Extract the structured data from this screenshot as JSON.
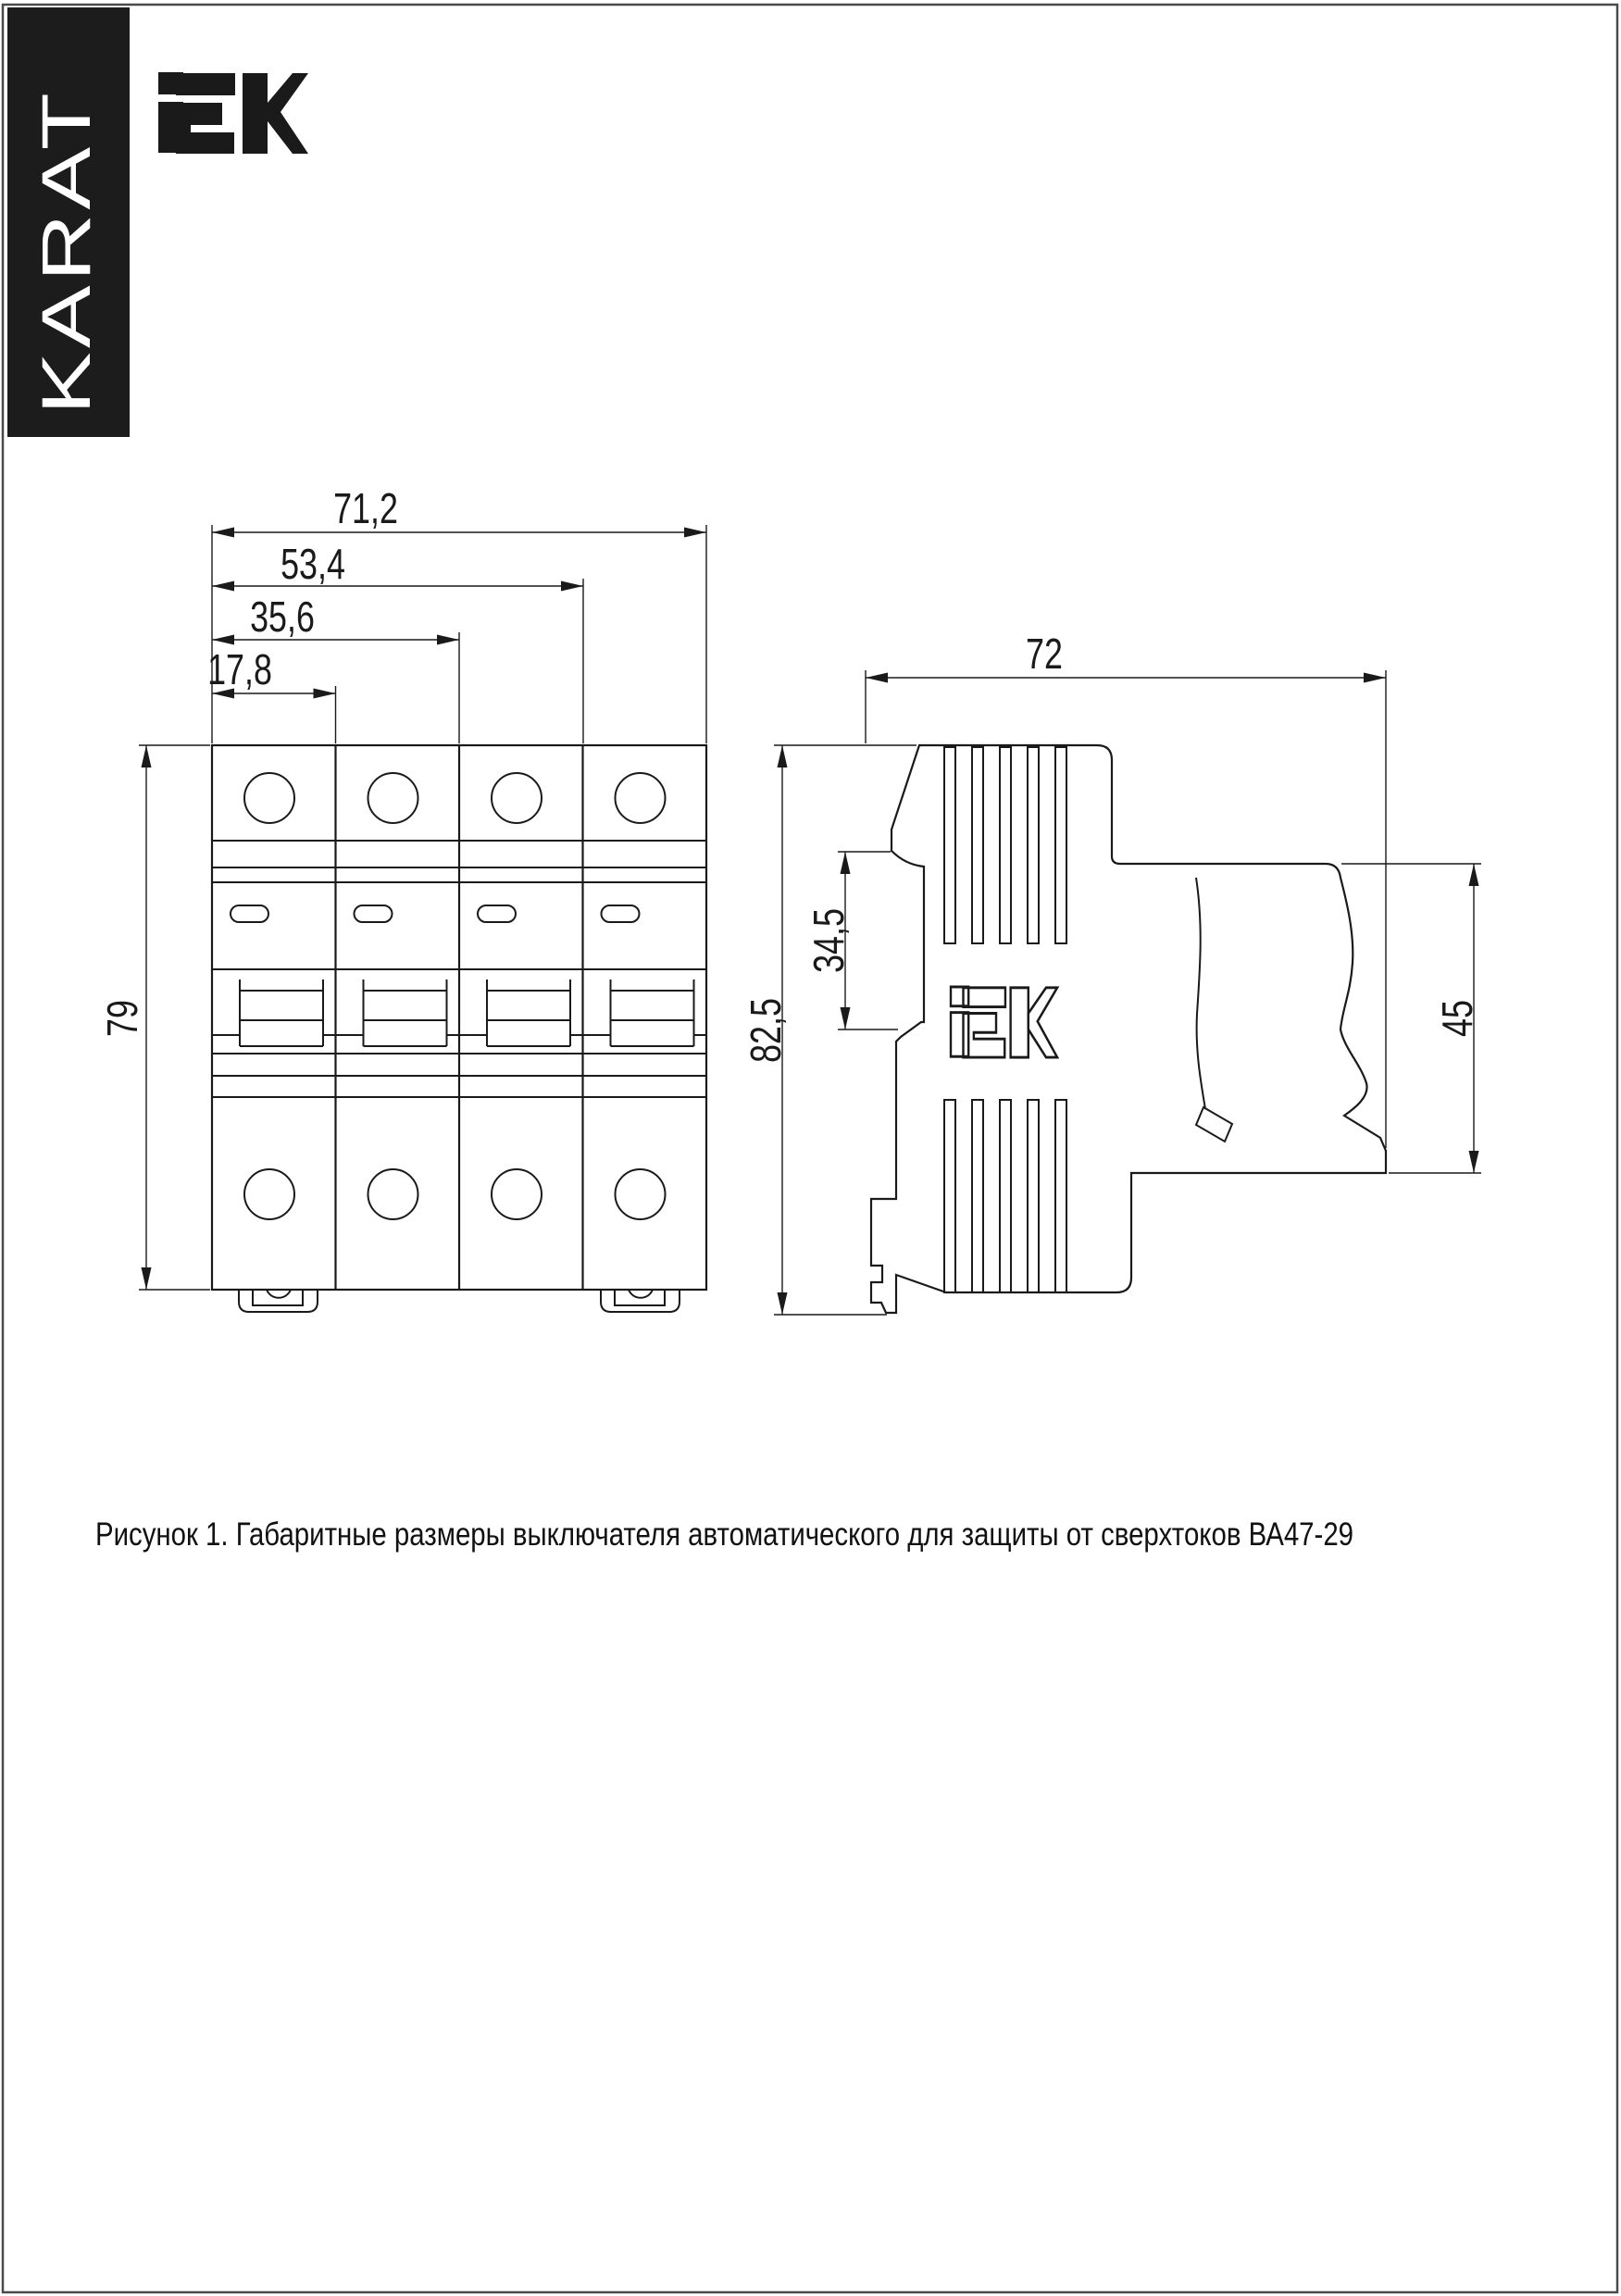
{
  "page": {
    "brand_vertical": "KARAT",
    "header_logo": "iEK",
    "caption": "Рисунок 1. Габаритные размеры выключателя автоматического для защиты от сверхтоков ВА47-29"
  },
  "drawing": {
    "front_view": {
      "dim_width_total": "71,2",
      "dim_width_3_modules": "53,4",
      "dim_width_2_modules": "35,6",
      "dim_width_1_module": "17,8",
      "dim_height": "79"
    },
    "side_view": {
      "dim_depth": "72",
      "dim_height_total": "82,5",
      "dim_rail_recess": "34,5",
      "dim_rear_height": "45",
      "embossed_logo": "iEK"
    }
  },
  "colors": {
    "ink": "#1a1a1a",
    "banner_background": "#1c1c1c",
    "banner_text": "#ffffff",
    "page_border": "#4a4a4a"
  }
}
